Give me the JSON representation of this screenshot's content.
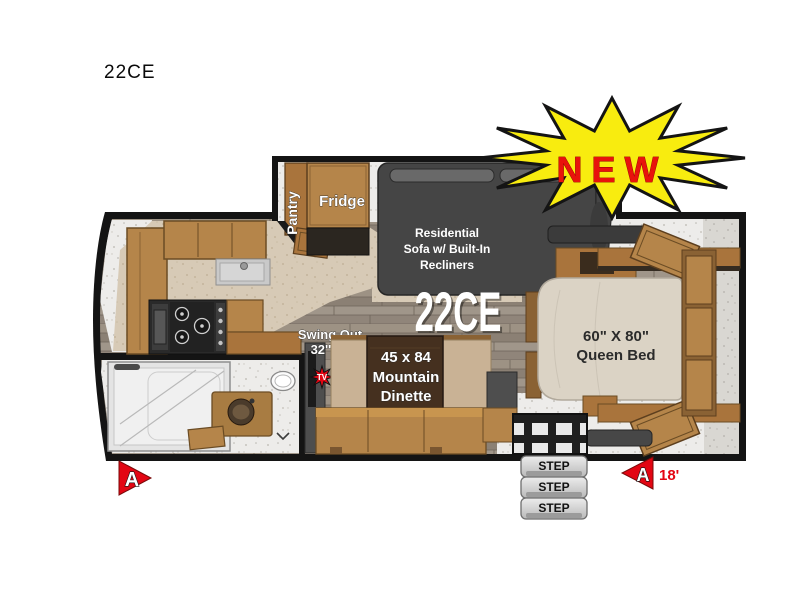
{
  "header": {
    "model": "22CE"
  },
  "badge": {
    "label": "NEW"
  },
  "slide": {
    "pantry": "Pantry",
    "fridge": "Fridge"
  },
  "sofa": {
    "line1": "Residential",
    "line2": "Sofa w/ Built-In",
    "line3": "Recliners"
  },
  "model_callout": "22CE",
  "tv": {
    "line1": "Swing Out",
    "line2": "32'' TV",
    "badge": "TV"
  },
  "dinette": {
    "line1": "45 x 84",
    "line2": "Mountain",
    "line3": "Dinette"
  },
  "bed": {
    "line1": "60\" X 80\"",
    "line2": "Queen Bed"
  },
  "steps": {
    "step1": "STEP",
    "step2": "STEP",
    "step3": "STEP"
  },
  "markers": {
    "front_label": "A",
    "rear_label": "A",
    "rear_distance": "18'"
  },
  "colors": {
    "wall": "#141414",
    "wood": "#b5854a",
    "wood_dark": "#8a6234",
    "sofa": "#454545",
    "mattress": "#dbd3c5",
    "burst_yellow": "#f8ec0f",
    "accent_red": "#e30613",
    "step_gray": "#d9d9d9"
  }
}
